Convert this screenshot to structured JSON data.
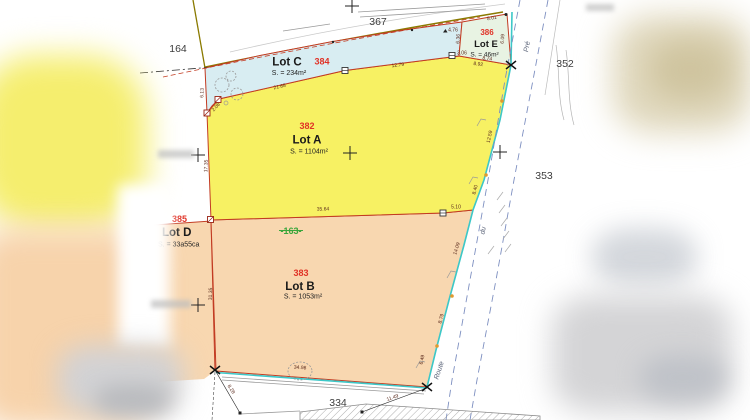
{
  "lots": {
    "a": {
      "num": "382",
      "name": "Lot A",
      "area": "S. = 1104m²"
    },
    "b": {
      "num": "383",
      "name": "Lot B",
      "area": "S. = 1053m²"
    },
    "c": {
      "num": "384",
      "name": "Lot C",
      "area": "S. = 234m²"
    },
    "d": {
      "num": "385",
      "name": "Lot D",
      "area": "S. = 33a55ca"
    },
    "e": {
      "num": "386",
      "name": "Lot E",
      "area": "S. = 46m²"
    }
  },
  "old_parcel": "-163-",
  "neighbors": {
    "n367": "367",
    "n164": "164",
    "n352": "352",
    "n353": "353",
    "n334": "334"
  },
  "roads": {
    "top": "Pré",
    "mid": "du",
    "bottom": "Route"
  },
  "dims": {
    "d21_68": "21.68",
    "d12_79": "12.79",
    "d2_08": "2.08",
    "d6_13": "6.13",
    "d17_35": "17.35",
    "d31_35": "31.35",
    "d8_01": "8.01",
    "d4_76": "4.76",
    "d6_36": "6.36",
    "d6_09": "6.09",
    "d3_06": "3.06",
    "d8_74": "8.74",
    "d8_92": "8.92",
    "d12_59": "12.59",
    "d8_40": "8.40",
    "d5_10": "5.10",
    "d35_64": "35.64",
    "d14_09": "14.09",
    "d8_79": "8.79",
    "d6_49": "6.49",
    "d34_98": "34.98",
    "d8_28": "8.28",
    "d11_49": "11.49"
  },
  "colors": {
    "lot_a_fill": "#f7f163",
    "lot_b_fill": "#f8d7b0",
    "lot_c_fill": "#d8edf2",
    "lot_d_fill": "#f8d7b0",
    "lot_e_fill": "#e8f3e3",
    "boundary_red": "#c23b22",
    "survey_teal": "#3cc8c8",
    "road_dash_blue": "#7d8fc0",
    "parcel_num_red": "#e03226",
    "old_parcel_green": "#3aa63c",
    "road_edge_olive": "#8a7a00"
  }
}
